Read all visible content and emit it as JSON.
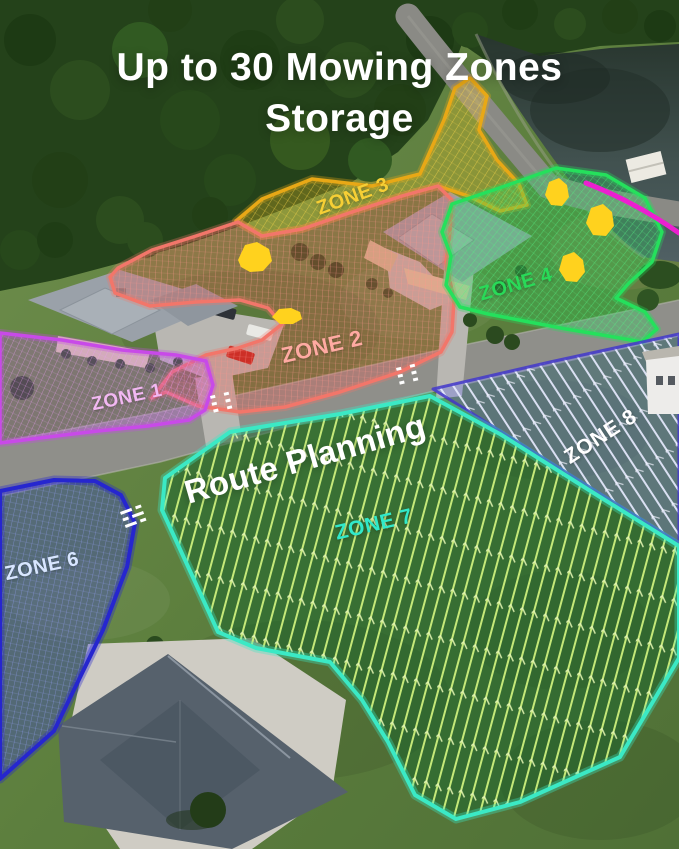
{
  "title": {
    "line1": "Up to 30 Mowing Zones",
    "line2": "Storage"
  },
  "overlay_labels": {
    "route_planning": "Route Planning"
  },
  "zones": [
    {
      "label": "ZONE 1",
      "outline_color": "#c84ae8",
      "label_color": "#f2b8f2",
      "fill_style": "purple-hatch"
    },
    {
      "label": "ZONE 2",
      "outline_color": "#f2766a",
      "label_color": "#ffaaa2",
      "fill_style": "red-hatch"
    },
    {
      "label": "ZONE 3",
      "outline_color": "#e8a816",
      "label_color": "#f6cf35",
      "fill_style": "gold-hatch"
    },
    {
      "label": "ZONE 4",
      "outline_color": "#25e05c",
      "label_color": "#29da58",
      "fill_style": "green-hatch"
    },
    {
      "label": "ZONE 6",
      "outline_color": "#2626cf",
      "label_color": "#d8e6ff",
      "fill_style": "blue-hatch"
    },
    {
      "label": "ZONE 7",
      "outline_color": "#3be9c5",
      "label_color": "#31e9c9",
      "fill_style": "route-stripes-green"
    },
    {
      "label": "ZONE 8",
      "outline_color": "#6c76eb",
      "label_color": "#ffffff",
      "fill_style": "route-stripes-periwinkle"
    }
  ],
  "unlabeled_zone_outline_color": "#ec1fd0",
  "tree_marker_color": "#ffd21e",
  "tree_marker_counts": {
    "zone2": 2,
    "zone4": 3
  },
  "scene_colors": {
    "grass": "#5d7c3e",
    "forest": "#24421a",
    "lake": "#3c4c4e",
    "road": "#8f8f8a",
    "crosswalk_markings": "#ffffff",
    "roof_gray": "#99a0a8",
    "roof_dark": "#56616c",
    "concrete": "#cfccc4",
    "car_red": "#c01e16",
    "car_white": "#e9e9e5"
  }
}
